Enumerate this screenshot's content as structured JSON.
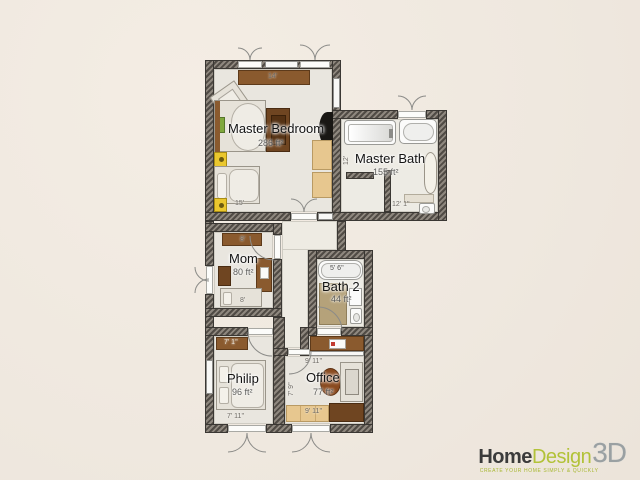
{
  "app": {
    "name": "Home Design 3D floor plan view",
    "logo": {
      "word1": "Home",
      "word2": "Design",
      "word3": "3D",
      "tagline": "CREATE YOUR HOME SIMPLY & QUICKLY"
    }
  },
  "colors": {
    "background": "#f1eae1",
    "wall_dark": "#504b45",
    "wall_light": "#8e877e",
    "floor": "#e9e6df",
    "wood": "#8a5a2e",
    "accent_yellow": "#eac72e",
    "logo_green": "#b2c238",
    "logo_dark": "#3b3b3b",
    "logo_gray": "#9aa0a2"
  },
  "rooms": [
    {
      "id": "master-bedroom",
      "label": "Master Bedroom",
      "area": "286 ft²"
    },
    {
      "id": "master-bath",
      "label": "Master Bath",
      "area": "155 ft²"
    },
    {
      "id": "mom",
      "label": "Mom",
      "area": "80 ft²"
    },
    {
      "id": "bath-2",
      "label": "Bath 2",
      "area": "44 ft²"
    },
    {
      "id": "philip",
      "label": "Philip",
      "area": "96 ft²"
    },
    {
      "id": "office",
      "label": "Office",
      "area": "77 ft²"
    }
  ],
  "dimensions": {
    "master_bedroom_top": "14'",
    "master_bedroom_bottom": "15'",
    "master_bath_left": "12'",
    "master_bath_bottom": "12' 1''",
    "mom_top": "8'",
    "mom_bottom": "8'",
    "bath2_tub": "5' 6''",
    "philip_top": "7' 1''",
    "philip_bottom": "7' 11''",
    "office_top": "9' 11''",
    "office_left": "7' 9''",
    "office_bottom": "9' 11''"
  }
}
